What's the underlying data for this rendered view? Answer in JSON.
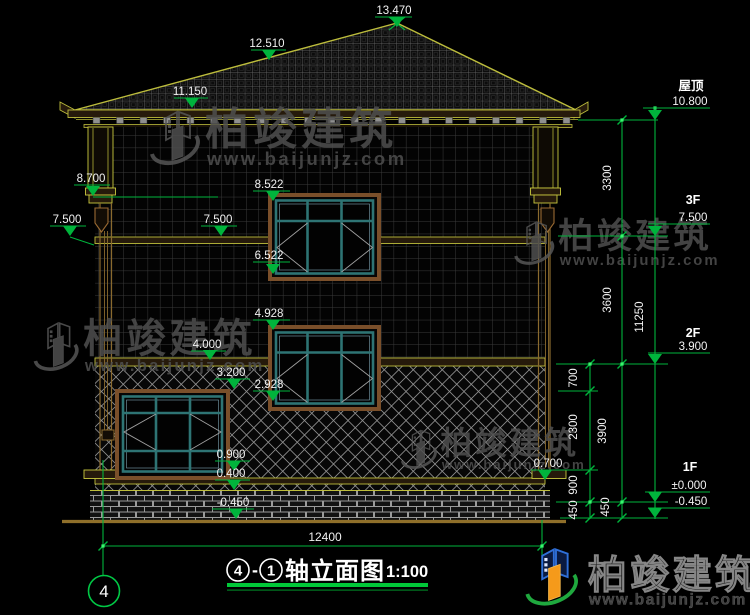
{
  "page": {
    "type": "CAD elevation drawing viewer",
    "background": "#000000"
  },
  "title": {
    "axis_from": "4",
    "separator": "-",
    "axis_to": "1",
    "name": "轴立面图",
    "scale": "1:100"
  },
  "axis_bubble": "4",
  "dims": {
    "overall_width": "12400"
  },
  "watermark": {
    "company": "柏竣建筑",
    "website": "www.baijunjz.com"
  },
  "logo": {
    "company": "柏竣建筑",
    "website": "www.baijunjz.com"
  },
  "colors": {
    "dim_green": "#00b43c",
    "bright_green": "#39f56e",
    "cad_yellow": "#bdbd3c",
    "frame_teal": "#2e7474",
    "casing_brown": "#7a4f2a",
    "text_white": "#f2f2f2",
    "logo_blue": "#2f6fd8",
    "logo_orange": "#f59a1a",
    "logo_green": "#1fa83e"
  },
  "annotations": {
    "level_markers": [
      {
        "label": "13.470",
        "tx": 394,
        "ty": 14,
        "line": [
          375,
          412,
          17
        ],
        "apex": [
          397,
          27
        ],
        "cross": true
      },
      {
        "label": "12.510",
        "tx": 267,
        "ty": 47,
        "line": [
          251,
          286,
          50
        ],
        "apex": [
          269,
          60
        ]
      },
      {
        "label": "11.150",
        "tx": 190,
        "ty": 95,
        "line": [
          174,
          208,
          98
        ],
        "apex": [
          192,
          108
        ]
      },
      {
        "label": "8.700",
        "tx": 91,
        "ty": 182,
        "line": [
          74,
          110,
          185
        ],
        "apex": [
          93,
          196
        ]
      },
      {
        "label": "7.500",
        "tx": 67,
        "ty": 223,
        "line": [
          50,
          86,
          226
        ],
        "apex": [
          70,
          236
        ]
      },
      {
        "label": "7.500",
        "tx": 218,
        "ty": 223,
        "line": [
          201,
          237,
          226
        ],
        "apex": [
          221,
          236
        ]
      },
      {
        "label": "8.522",
        "tx": 269,
        "ty": 188,
        "line": [
          253,
          290,
          191
        ],
        "apex": [
          273,
          201
        ]
      },
      {
        "label": "6.522",
        "tx": 269,
        "ty": 259,
        "line": [
          253,
          290,
          262
        ],
        "apex": [
          273,
          274
        ]
      },
      {
        "label": "4.928",
        "tx": 269,
        "ty": 317,
        "line": [
          253,
          290,
          320
        ],
        "apex": [
          273,
          330
        ]
      },
      {
        "label": "4.000",
        "tx": 207,
        "ty": 348,
        "line": [
          191,
          226,
          351
        ],
        "apex": [
          210,
          360
        ]
      },
      {
        "label": "3.200",
        "tx": 231,
        "ty": 376,
        "line": [
          215,
          250,
          379
        ],
        "apex": [
          234,
          389
        ]
      },
      {
        "label": "2.928",
        "tx": 269,
        "ty": 388,
        "line": [
          253,
          290,
          391
        ],
        "apex": [
          273,
          401
        ]
      },
      {
        "label": "0.900",
        "tx": 231,
        "ty": 458,
        "line": [
          215,
          250,
          461
        ],
        "apex": [
          234,
          471
        ]
      },
      {
        "label": "0.400",
        "tx": 231,
        "ty": 477,
        "line": [
          215,
          250,
          480
        ],
        "apex": [
          234,
          490
        ]
      },
      {
        "label": "-0.450",
        "tx": 233,
        "ty": 506,
        "line": [
          212,
          254,
          509
        ],
        "apex": [
          236,
          519
        ]
      },
      {
        "label": "0.700",
        "tx": 548,
        "ty": 467,
        "line": [
          531,
          565,
          470
        ],
        "apex": [
          545,
          480
        ]
      },
      {
        "label": "10.800",
        "floor": "屋顶",
        "ftx": 691,
        "fty": 90,
        "tx": 690,
        "ty": 105,
        "line": [
          643,
          710,
          108
        ],
        "apex": [
          655,
          120
        ]
      },
      {
        "label": "7.500",
        "floor": "3F",
        "ftx": 693,
        "fty": 204,
        "tx": 693,
        "ty": 221,
        "line": [
          648,
          710,
          224
        ],
        "apex": [
          655,
          236
        ]
      },
      {
        "label": "3.900",
        "floor": "2F",
        "ftx": 693,
        "fty": 337,
        "tx": 693,
        "ty": 350,
        "line": [
          648,
          710,
          353
        ],
        "apex": [
          655,
          364
        ]
      },
      {
        "label": "±0.000",
        "floor": "1F",
        "ftx": 690,
        "fty": 471,
        "tx": 689,
        "ty": 489,
        "line": [
          645,
          710,
          492
        ],
        "apex": [
          655,
          502
        ]
      },
      {
        "label": "-0.450",
        "tx": 691,
        "ty": 505,
        "line": [
          648,
          710,
          508
        ],
        "apex": [
          655,
          518
        ]
      }
    ],
    "vertical_dims": [
      {
        "label": "3300",
        "x": 611,
        "y": 178
      },
      {
        "label": "3600",
        "x": 611,
        "y": 300
      },
      {
        "label": "3900",
        "x": 606,
        "y": 431
      },
      {
        "label": "450",
        "x": 609,
        "y": 507
      },
      {
        "label": "11250",
        "x": 643,
        "y": 317
      },
      {
        "label": "700",
        "x": 577,
        "y": 378
      },
      {
        "label": "2300",
        "x": 577,
        "y": 427
      },
      {
        "label": "900",
        "x": 577,
        "y": 485
      },
      {
        "label": "450",
        "x": 577,
        "y": 510
      }
    ],
    "green_vlines": [
      [
        590,
        364,
        519
      ],
      [
        622,
        120,
        519
      ],
      [
        655,
        108,
        519
      ],
      [
        103,
        460,
        576
      ],
      [
        542,
        520,
        574
      ]
    ],
    "green_hlines": [
      [
        578,
        658,
        120
      ],
      [
        558,
        668,
        236
      ],
      [
        556,
        668,
        364
      ],
      [
        558,
        598,
        391
      ],
      [
        552,
        598,
        470
      ],
      [
        556,
        668,
        502
      ],
      [
        560,
        668,
        518
      ],
      [
        93,
        218,
        197
      ],
      [
        103,
        542,
        546
      ]
    ],
    "leader_lines": [
      [
        70,
        237,
        94,
        245
      ]
    ],
    "ticks": [
      [
        590,
        364
      ],
      [
        590,
        391
      ],
      [
        590,
        470
      ],
      [
        590,
        502
      ],
      [
        590,
        518
      ],
      [
        622,
        120
      ],
      [
        622,
        236
      ],
      [
        622,
        364
      ],
      [
        622,
        502
      ],
      [
        622,
        518
      ],
      [
        103,
        546
      ],
      [
        542,
        546
      ]
    ],
    "dots": [
      [
        622,
        120
      ],
      [
        622,
        236
      ],
      [
        622,
        364
      ],
      [
        590,
        364
      ],
      [
        655,
        108
      ],
      [
        103,
        546
      ],
      [
        542,
        546
      ],
      [
        590,
        502
      ],
      [
        622,
        502
      ]
    ]
  }
}
